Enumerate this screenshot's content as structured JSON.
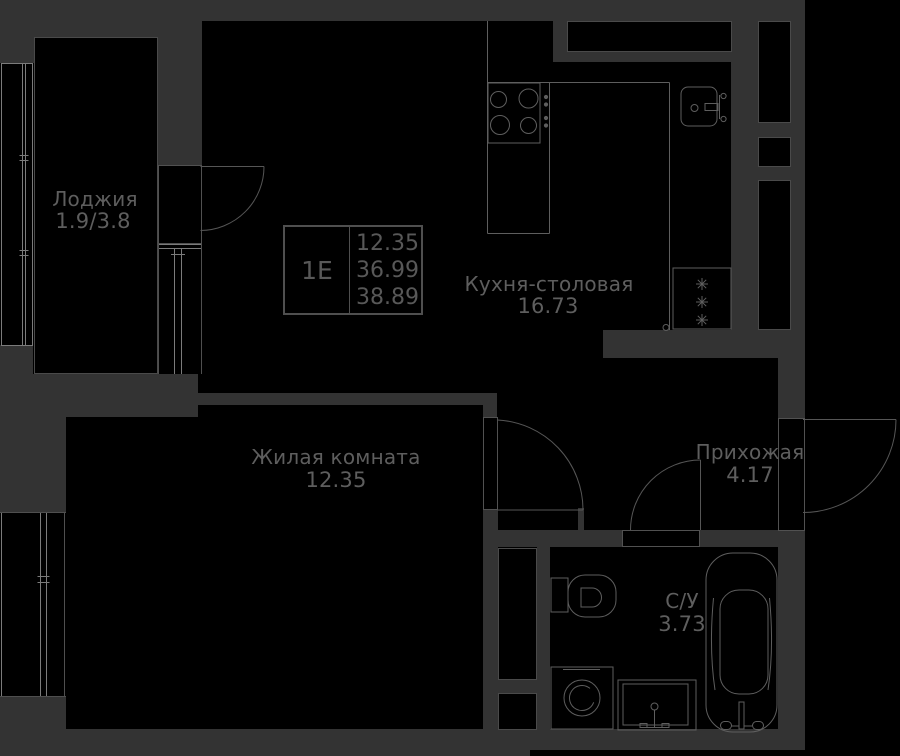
{
  "plan": {
    "title": "apartment floor plan",
    "unit": {
      "type": "1Е",
      "area1": "12.35",
      "area2": "36.99",
      "area3": "38.89"
    },
    "rooms": {
      "loggia": {
        "name": "Лоджия",
        "area": "1.9/3.8"
      },
      "kitchen": {
        "name": "Кухня-столовая",
        "area": "16.73"
      },
      "living": {
        "name": "Жилая комната",
        "area": "12.35"
      },
      "hall": {
        "name": "Прихожая",
        "area": "4.17"
      },
      "bath": {
        "name": "С/У",
        "area": "3.73"
      }
    },
    "icons": {
      "stove": "stove-icon",
      "kitchen_sink": "kitchen-sink-icon",
      "fridge": "fridge-icon",
      "toilet": "toilet-icon",
      "washing_machine": "washing-machine-icon",
      "vanity_sink": "vanity-sink-icon",
      "bathtub": "bathtub-icon"
    },
    "colors": {
      "wall": "#333333",
      "bg": "#000000",
      "line": "#5e5e5e",
      "window_line": "#7b7b7b",
      "edge": "#4f4f4f",
      "text": "#5e5e5e"
    }
  }
}
